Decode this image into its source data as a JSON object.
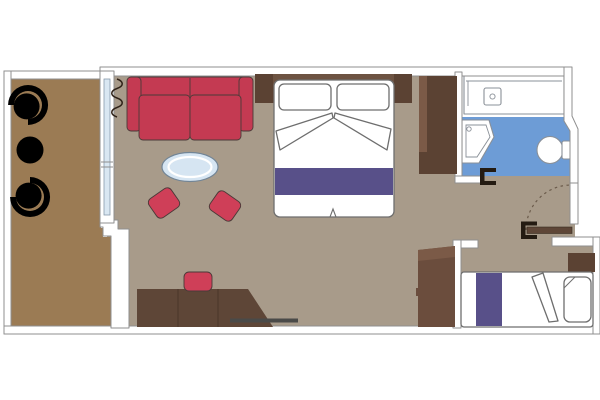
{
  "canvas": {
    "width": 600,
    "height": 400
  },
  "scene": {
    "type": "floor-plan",
    "description": "Cabin floor plan: balcony, living and sleeping area, bathroom, entry hall, second sofa bed"
  },
  "rooms": [
    {
      "name": "balcony"
    },
    {
      "name": "living-sleeping-area"
    },
    {
      "name": "bathroom"
    },
    {
      "name": "entry-hallway"
    },
    {
      "name": "second-sleeping-area"
    }
  ],
  "elements": {
    "balcony": [
      "tub-chair",
      "round-table",
      "tub-chair",
      "sliding-glass-door",
      "curtain"
    ],
    "living_sleeping": [
      "sofa",
      "oval-coffee-table",
      "ottoman",
      "ottoman",
      "double-bed",
      "pillows",
      "bed-runner",
      "headboard",
      "nightstands",
      "desk",
      "desk-chair",
      "wardrobe",
      "low-cabinet"
    ],
    "bathroom": [
      "vanity-counter",
      "washbasin",
      "corner-sink",
      "toilet",
      "shower-floor",
      "door-jamb"
    ],
    "entry": [
      "entry-door",
      "door-swing-arc",
      "door-jamb"
    ],
    "second_sleeping": [
      "sofa-bed",
      "bed-runner",
      "pillow",
      "folded-blanket",
      "shelf"
    ]
  },
  "colors": {
    "bg": "#ffffff",
    "wall_fill": "#ffffff",
    "wall_stroke": "#8f8f8f",
    "floor": "#a89b8a",
    "balcony_floor": "#9b7b54",
    "bath_blue": "#6d9cd6",
    "glass": "#d9e7f2",
    "purple": "#585089",
    "sofa_red": "#c43a52",
    "accent_red": "#cf3f58",
    "wood_dark": "#5b4233",
    "wood_mid": "#6d5342",
    "wood_desk": "#5e4637",
    "wood_cab": "#6b4d3d",
    "wood_light": "#7b5a47",
    "table_blue": "#d6e5f2",
    "furn_white": "#ffffff",
    "furn_stroke": "#6e6e6e",
    "dark_stroke": "#4a3a38",
    "fixture_stroke": "#8a9098",
    "arc_stroke": "#6b5b4b",
    "bracket": "#241b12",
    "rail": "#4a4a48",
    "curtain_stroke": "#2f2218"
  }
}
